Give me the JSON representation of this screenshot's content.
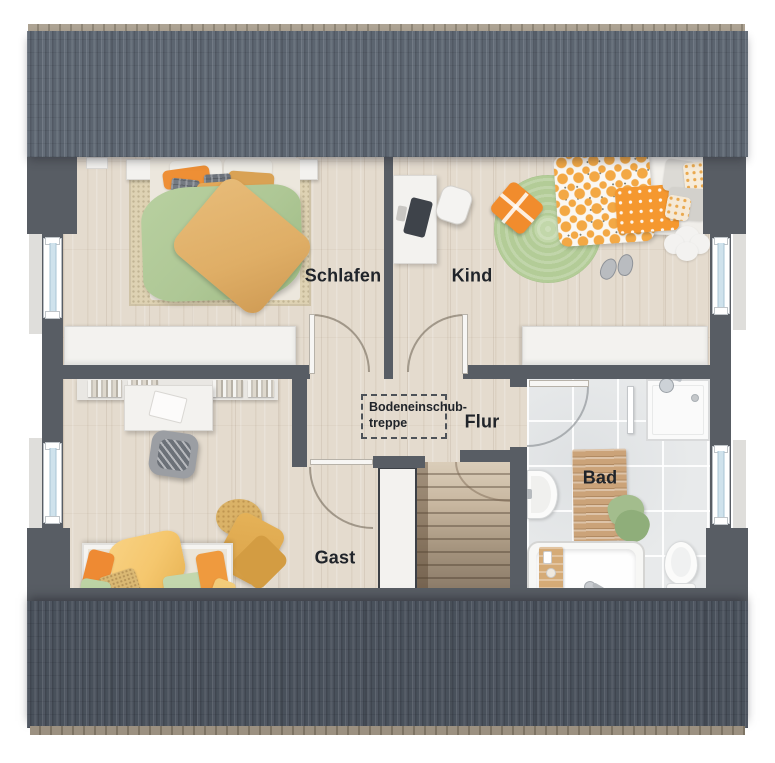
{
  "floorplan": {
    "rooms": [
      {
        "id": "schlafen",
        "label": "Schlafen"
      },
      {
        "id": "kind",
        "label": "Kind"
      },
      {
        "id": "flur",
        "label": "Flur"
      },
      {
        "id": "gast",
        "label": "Gast"
      },
      {
        "id": "bad",
        "label": "Bad"
      }
    ],
    "attic_hatch": {
      "line1": "Bodeneinschub-",
      "line2": "treppe"
    }
  },
  "colors": {
    "wall": "#585d64",
    "roof-top": "#5f6874",
    "roof-bottom": "#4c545f",
    "ridge-top": "#ada393",
    "ridge-bottom": "#9c9181",
    "wood-floor": "#e4dbce",
    "tile-floor": "#e8eaeb",
    "rug-beige": "#ded2b3",
    "rug-green": "#b3cc97",
    "duvet-green": "#aec795",
    "duvet-tan": "#dfae66",
    "accent-orange": "#ee8f35",
    "accent-yellow": "#f5c76e",
    "window-glass": "#cfe2ec",
    "label-text": "#20242a",
    "stairs-light": "#dacdb9",
    "stairs-dark": "#847463",
    "furniture-white": "#f3f2ef"
  }
}
